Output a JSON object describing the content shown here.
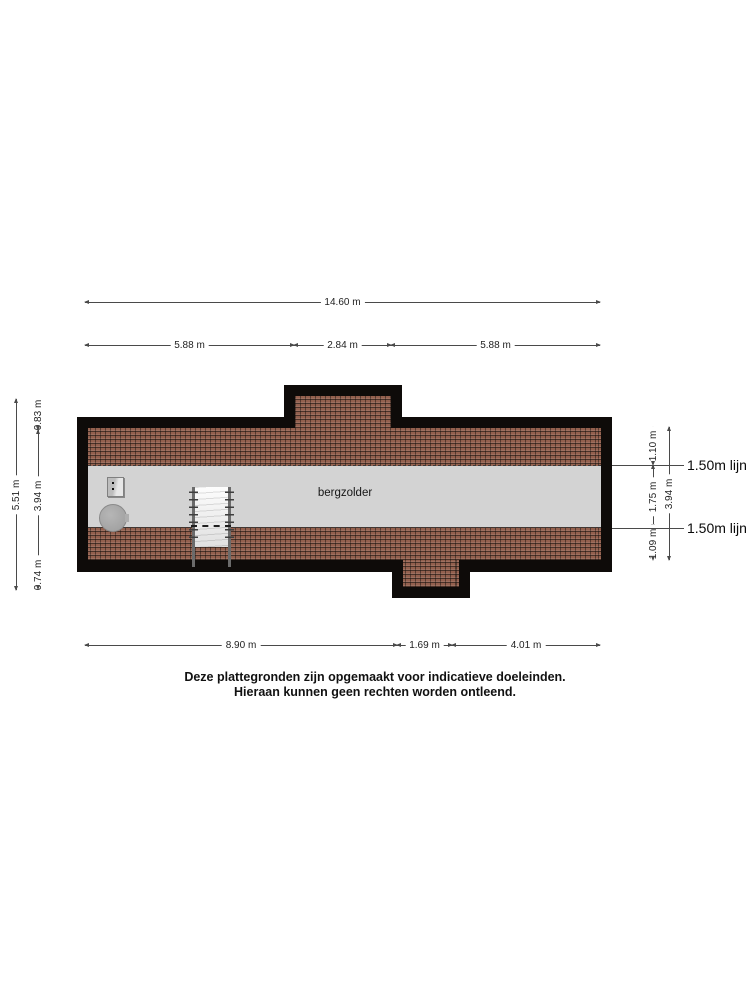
{
  "page": {
    "disclaimer": [
      "Deze plattegronden zijn opgemaakt voor indicatieve doeleinden.",
      "Hieraan kunnen geen rechten worden ontleend."
    ]
  },
  "floorplan": {
    "room_label": "bergzolder",
    "height_lines": {
      "top_label": "1.50m lijn",
      "bottom_label": "1.50m lijn"
    },
    "dimensions": {
      "top_total": "14.60 m",
      "top_segments": [
        "5.88 m",
        "2.84 m",
        "5.88 m"
      ],
      "bottom_segments": [
        "8.90 m",
        "1.69 m",
        "4.01 m"
      ],
      "left_total": "5.51 m",
      "left_segments": [
        "0.83 m",
        "3.94 m",
        "0.74 m"
      ],
      "right_segments": [
        "1.10 m",
        "1.75 m",
        "1.09 m"
      ],
      "right_total": "3.94 m"
    },
    "colors": {
      "wall": "#0e0b09",
      "roof_tile": "#93604e",
      "floor": "#d3d3d3",
      "dimension_line": "#4a4a4a"
    }
  }
}
